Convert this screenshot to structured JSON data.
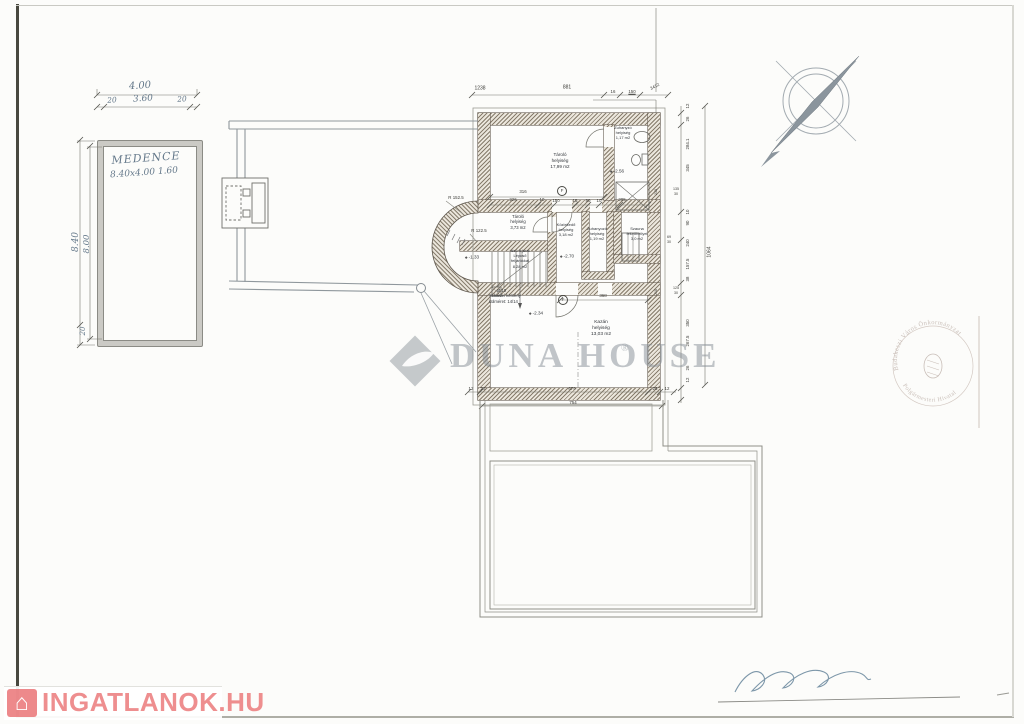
{
  "pool": {
    "title": "MEDENCE",
    "size": "8.40x4.00 1.60",
    "dims": {
      "total": "4.00",
      "left": "20",
      "mid": "3.60",
      "right": "20",
      "h_out": "8.40",
      "h_in": "8.00",
      "h_bottom": "20"
    }
  },
  "plan": {
    "top_dims": [
      "1238",
      "881",
      "16",
      "150",
      "3412"
    ],
    "inner_dims": {
      "w316": "316",
      "row": [
        "226",
        "10",
        "150",
        "15",
        "90",
        "10",
        "205"
      ]
    },
    "grid_mark": "F",
    "right_dims": {
      "chain": [
        "12",
        "26",
        "284.1",
        "345",
        "10",
        "90",
        "240",
        "157.5",
        "38",
        "350",
        "267.5",
        "26",
        "12"
      ],
      "total": "1064",
      "stack1": [
        "135",
        "30"
      ],
      "stack2": [
        "125",
        "30"
      ],
      "stack3": [
        "69",
        "30"
      ],
      "wall_marks": [
        "218",
        "218"
      ]
    },
    "bottom_dims": {
      "row": [
        "12",
        "26",
        "679",
        "26",
        "12"
      ],
      "total": "754"
    },
    "kazan_dim": "368",
    "levels": {
      "shower": "-2.56",
      "mid": "-2.70",
      "kazan": "-2.34",
      "bay": "-1.33"
    },
    "radii": {
      "outer": "R 152.5",
      "inner": "R 122.5"
    },
    "rooms": {
      "storage_big": {
        "l1": "Tároló",
        "l2": "helyiség",
        "l3": "17,99 m2"
      },
      "shower_top": {
        "l1": "Zuhanyzó",
        "l2": "helyiség",
        "l3": "1,17 m2"
      },
      "storage_small": {
        "l1": "Tároló",
        "l2": "helyiség",
        "l3": "3,73 m2"
      },
      "stairs": {
        "l1": "alsó lejárat",
        "l2": "Lépcső",
        "l3": "feljárókkal",
        "l4": "8,28 m2"
      },
      "corridor": {
        "l1": "Közlekedő",
        "l2": "helyiség",
        "l3": "3,18 m2"
      },
      "shower_mid": {
        "l1": "Zuhanyozó",
        "l2": "helyiség",
        "l3": "1,19 m2"
      },
      "sauna": {
        "l1": "Szauna",
        "l2": "fekvőhellyel",
        "l3": "3,0 m2"
      },
      "boiler": {
        "l1": "Kazán",
        "l2": "helyiség",
        "l3": "13,03 m2"
      },
      "chimney": {
        "l1": "Ø 10",
        "l2": "Schiedel kémény",
        "l3": "külméret: 14/14"
      }
    }
  },
  "watermark": {
    "brand": "DUNA HOUSE",
    "reg": "®"
  },
  "logo": {
    "text": "INGATLANOK.HU",
    "icon": "⌂"
  },
  "stamp": {
    "arc_top": "Budakeszi Város Önkormányzat",
    "arc_bottom": "Polgármesteri Hivatal"
  }
}
